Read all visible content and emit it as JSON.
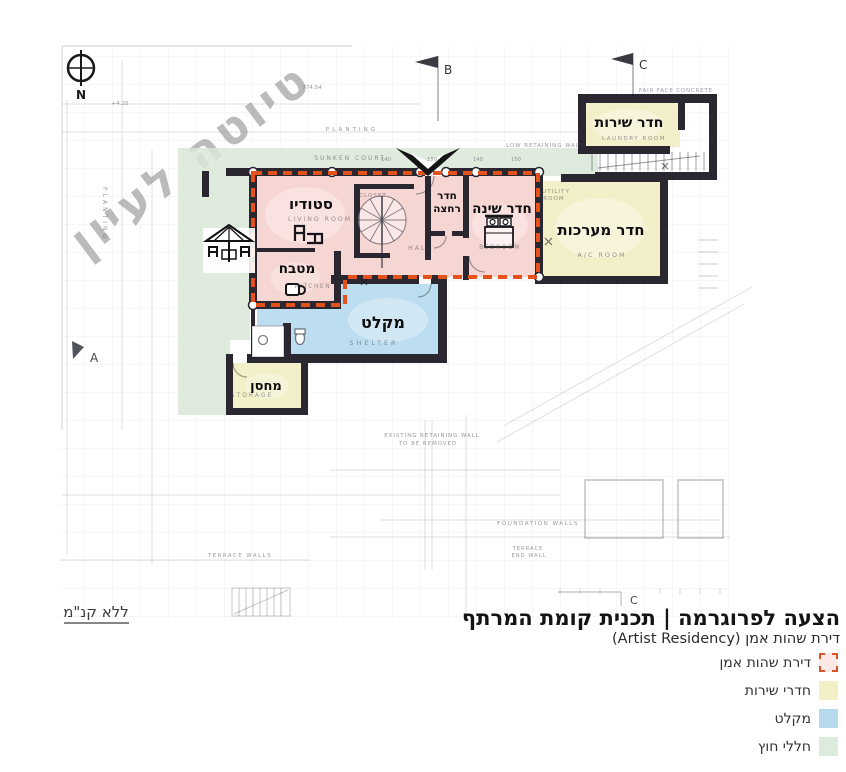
{
  "watermark": "טיוטה לעיון",
  "scale_note": "ללא קנ\"מ",
  "north_label": "N",
  "grid_markers": {
    "top_b": "B",
    "top_c": "C",
    "left_a": "A",
    "bottom_c": "C"
  },
  "rooms": {
    "studio": "סטודיו",
    "kitchen": "מטבח",
    "bathroom_line1": "חדר",
    "bathroom_line2": "רחצה",
    "bedroom": "חדר שינה",
    "systems": "חדר מערכות",
    "service": "חדר שירות",
    "shelter": "מקלט",
    "storage": "מחסן"
  },
  "annotations": {
    "living_room": "LIVING ROOM",
    "closet": "CLOSET",
    "hall": "HALL",
    "kitchen_en": "KITCHEN",
    "bedroom_en": "BEDROOM",
    "shelter_en": "SHELTER",
    "storage_en": "STORAGE",
    "ac_room": "A/C ROOM",
    "utility_line1": "UTILITY",
    "utility_line2": "ROOM",
    "laundry": "LAUNDRY ROOM",
    "sunken_court": "SUNKEN COURT",
    "low_wall": "LOW RETAINING WALL",
    "fair_face": "FAIR FACE CONCRETE",
    "planting_v": "PLANTING",
    "planting_h": "PLANTING",
    "terrace_walls": "TERRACE WALLS",
    "existing_line1": "EXISTING RETAINING WALL",
    "existing_line2": "TO BE REMOVED",
    "foundation": "FOUNDATION WALLS",
    "terrace_end_line1": "TERRACE",
    "terrace_end_line2": "END WALL",
    "elevation": "774.54",
    "level_mark": "+4.25",
    "dim_numbers": [
      "140",
      "150",
      "140",
      "150"
    ]
  },
  "title_block": {
    "title": "הצעה לפרוגרמה | תכנית קומת המרתף",
    "subtitle": "דירת שהות אמן (Artist Residency)"
  },
  "legend": {
    "items": [
      {
        "label": "דירת שהות אמן",
        "type": "dashed-residency"
      },
      {
        "label": "חדרי שירות",
        "type": "service"
      },
      {
        "label": "מקלט",
        "type": "shelter"
      },
      {
        "label": "חללי חוץ",
        "type": "outdoor"
      }
    ]
  },
  "colors": {
    "residency_fill": "#f5cfca",
    "residency_border": "#e4511a",
    "service_fill": "#f2edc2",
    "shelter_fill": "#b6daee",
    "outdoor_fill": "#d8e7d7",
    "wall": "#2a2731"
  }
}
